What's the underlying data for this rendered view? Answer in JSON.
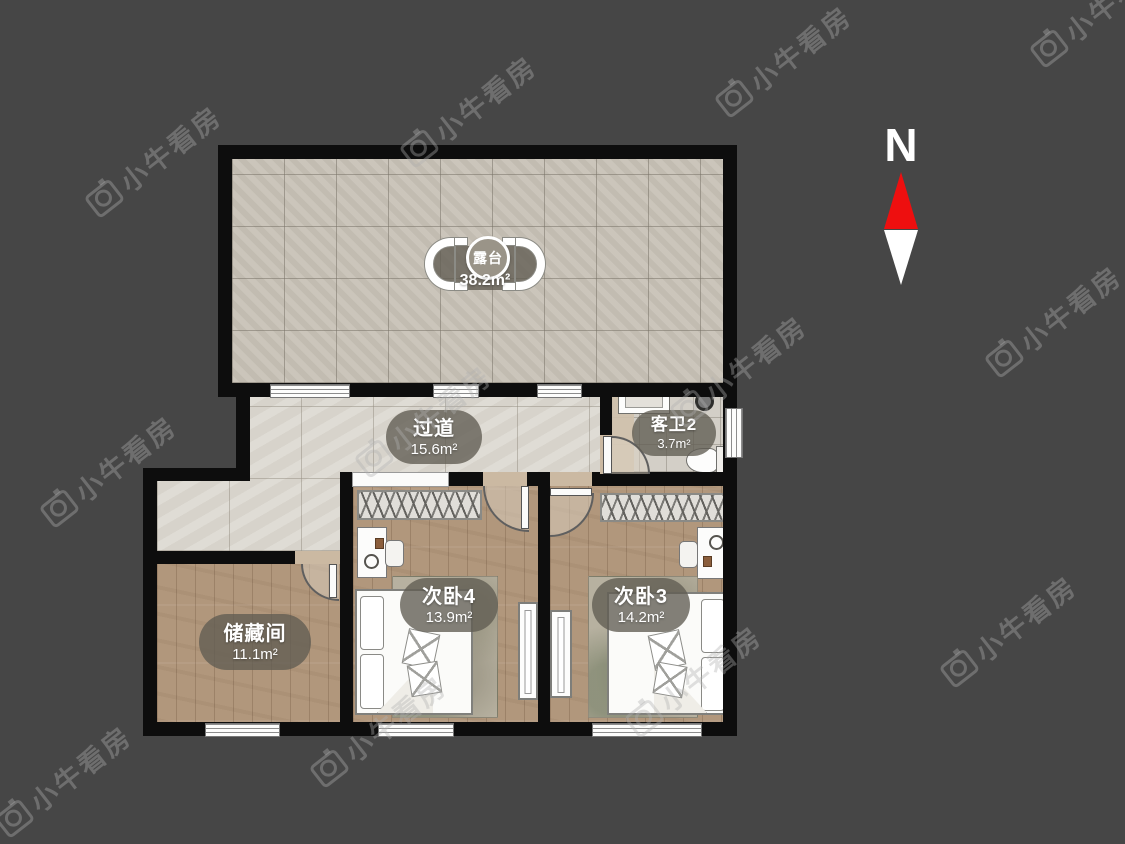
{
  "background": "#464646",
  "compass": {
    "label": "N"
  },
  "watermark": {
    "text": "小牛看房",
    "positions": [
      [
        75,
        140
      ],
      [
        390,
        90
      ],
      [
        705,
        40
      ],
      [
        1020,
        -10
      ],
      [
        30,
        450
      ],
      [
        345,
        400
      ],
      [
        660,
        350
      ],
      [
        975,
        300
      ],
      [
        -15,
        760
      ],
      [
        300,
        710
      ],
      [
        615,
        660
      ],
      [
        930,
        610
      ]
    ]
  },
  "colors": {
    "bg": "#464646",
    "wall": "#0d0d0d",
    "terrace-tile": "#c8c2b7",
    "corridor-tile": "#dbd7cf",
    "bath-tile": "#d3cfc7",
    "wood": "#b1977c",
    "label-bg": "rgba(96,92,82,0.78)",
    "label-text": "#ffffff",
    "compass-red": "#ee0f0f",
    "watermark-color": "rgba(175,175,175,0.38)"
  },
  "rooms": {
    "terrace": {
      "name": "露台",
      "area": "38.2m²"
    },
    "hallway": {
      "name": "过道",
      "area": "15.6m²"
    },
    "bathroom2": {
      "name": "客卫2",
      "area": "3.7m²"
    },
    "storage": {
      "name": "储藏间",
      "area": "11.1m²"
    },
    "bedroom4": {
      "name": "次卧4",
      "area": "13.9m²"
    },
    "bedroom3": {
      "name": "次卧3",
      "area": "14.2m²"
    }
  }
}
